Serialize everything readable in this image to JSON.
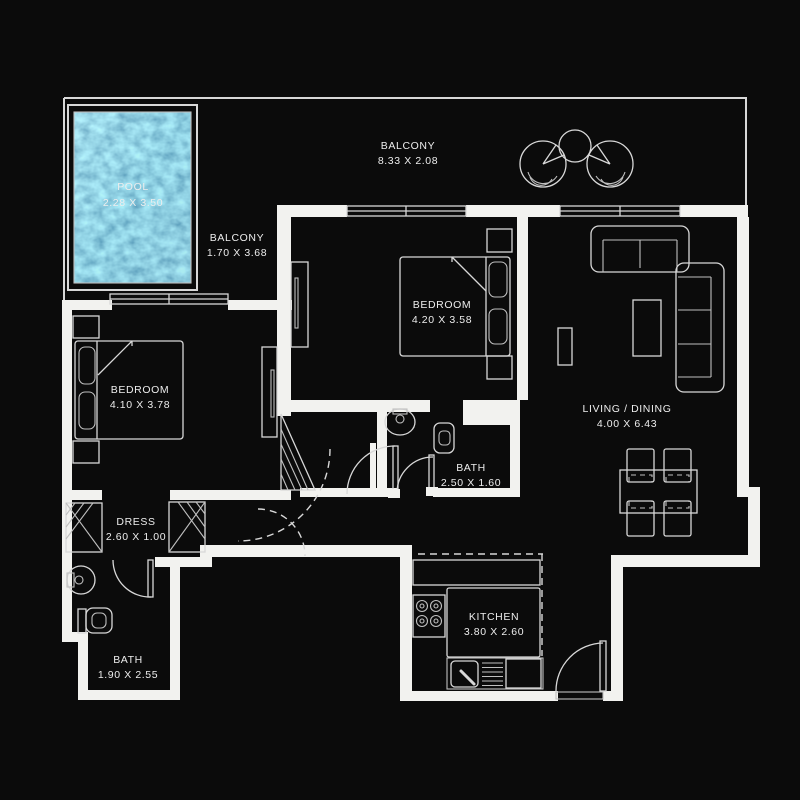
{
  "title": "Apartment Floor Plan",
  "colors": {
    "background": "#0b0b0b",
    "wall": "#f2f2ef",
    "line": "#d8d8d8",
    "dim_line": "#bfbfbf",
    "text": "#ededed",
    "pool_base": "#2f9fc0",
    "pool_light": "#8fd9ec",
    "pool_dark": "#18769c"
  },
  "rooms": {
    "pool": {
      "name": "POOL",
      "dims": "2.28 X 3.50"
    },
    "balcony_top": {
      "name": "BALCONY",
      "dims": "8.33 X 2.08"
    },
    "balcony_side": {
      "name": "BALCONY",
      "dims": "1.70 X 3.68"
    },
    "bedroom_center": {
      "name": "BEDROOM",
      "dims": "4.20 X 3.58"
    },
    "bedroom_left": {
      "name": "BEDROOM",
      "dims": "4.10 X 3.78"
    },
    "living_dining": {
      "name": "LIVING / DINING",
      "dims": "4.00 X 6.43"
    },
    "bath_center": {
      "name": "BATH",
      "dims": "2.50 X 1.60"
    },
    "dress": {
      "name": "DRESS",
      "dims": "2.60 X 1.00"
    },
    "bath_left": {
      "name": "BATH",
      "dims": "1.90 X 2.55"
    },
    "kitchen": {
      "name": "KITCHEN",
      "dims": "3.80 X 2.60"
    }
  }
}
